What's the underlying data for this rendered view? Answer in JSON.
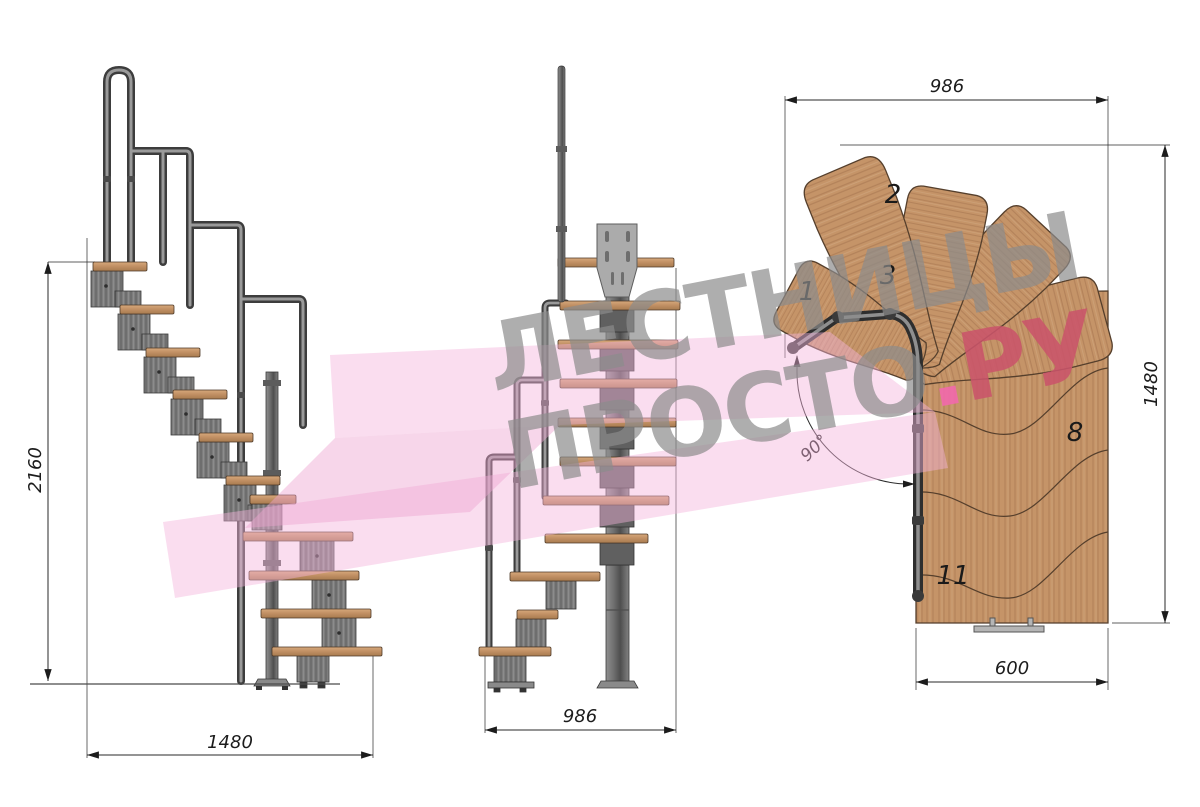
{
  "watermark": {
    "line1": "ЛЕСТНИЦЫ",
    "line2_main": "ПРОСТО",
    "line2_dot": ".",
    "line2_suffix": "РУ",
    "colors": {
      "gray": "#8c8c8c",
      "dot_pink": "#f069aa",
      "suffix_red": "#c9546a",
      "arrow_pink": "#f3b1da"
    }
  },
  "side_view": {
    "dim_height": "2160",
    "dim_length": "1480"
  },
  "front_view": {
    "dim_width": "986"
  },
  "plan_view": {
    "dim_width_top": "986",
    "dim_length_right": "1480",
    "dim_exit_bottom": "600",
    "dim_angle": "90°",
    "step_numbers": [
      "1",
      "2",
      "3",
      "8",
      "11"
    ]
  },
  "palette": {
    "wood": "#c59468",
    "steel": "#7c7c7c",
    "dimension_lines": "#2a2a2a",
    "background": "#ffffff"
  }
}
